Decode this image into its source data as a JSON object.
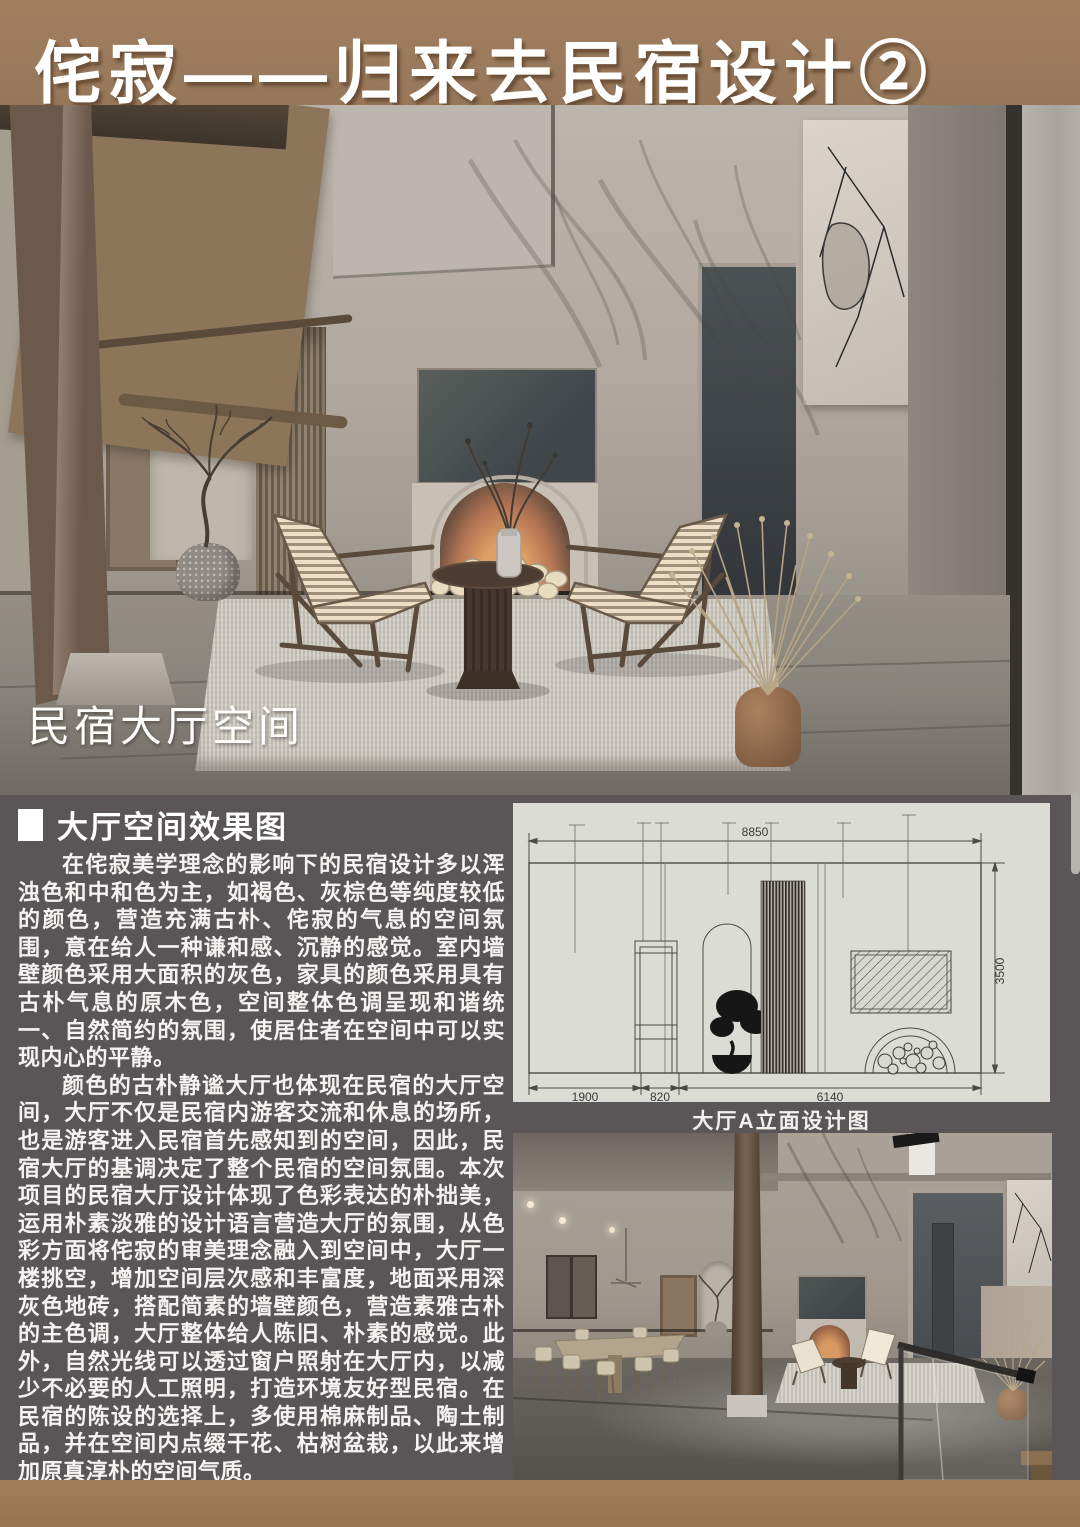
{
  "header": {
    "title": "侘寂——归来去民宿设计②"
  },
  "hero": {
    "label": "民宿大厅空间"
  },
  "article": {
    "heading": "大厅空间效果图",
    "paragraphs": [
      "在侘寂美学理念的影响下的民宿设计多以浑浊色和中和色为主，如褐色、灰棕色等纯度较低的颜色，营造充满古朴、侘寂的气息的空间氛围，意在给人一种谦和感、沉静的感觉。室内墙壁颜色采用大面积的灰色，家具的颜色采用具有古朴气息的原木色，空间整体色调呈现和谐统一、自然简约的氛围，使居住者在空间中可以实现内心的平静。",
      "颜色的古朴静谧大厅也体现在民宿的大厅空间，大厅不仅是民宿内游客交流和休息的场所，也是游客进入民宿首先感知到的空间，因此，民宿大厅的基调决定了整个民宿的空间氛围。本次项目的民宿大厅设计体现了色彩表达的朴拙美，运用朴素淡雅的设计语言营造大厅的氛围，从色彩方面将侘寂的审美理念融入到空间中，大厅一楼挑空，增加空间层次感和丰富度，地面采用深灰色地砖，搭配简素的墙壁颜色，营造素雅古朴的主色调，大厅整体给人陈旧、朴素的感觉。此外，自然光线可以透过窗户照射在大厅内，以减少不必要的人工照明，打造环境友好型民宿。在民宿的陈设的选择上，多使用棉麻制品、陶土制品，并在空间内点缀干花、枯树盆栽，以此来增加原真淳朴的空间气质。"
    ]
  },
  "elevation": {
    "caption": "大厅A立面设计图",
    "dim_total_width": "8850",
    "dim_height": "3500",
    "dim_left": "1900",
    "dim_mid": "820",
    "dim_right": "6140"
  },
  "colors": {
    "header_brown": "#9a7a5a",
    "footer_brown": "#9c7b54",
    "section_gray": "#5a5657",
    "drawing_bg": "#dcdcd6",
    "text_white": "#f4f3f1"
  }
}
